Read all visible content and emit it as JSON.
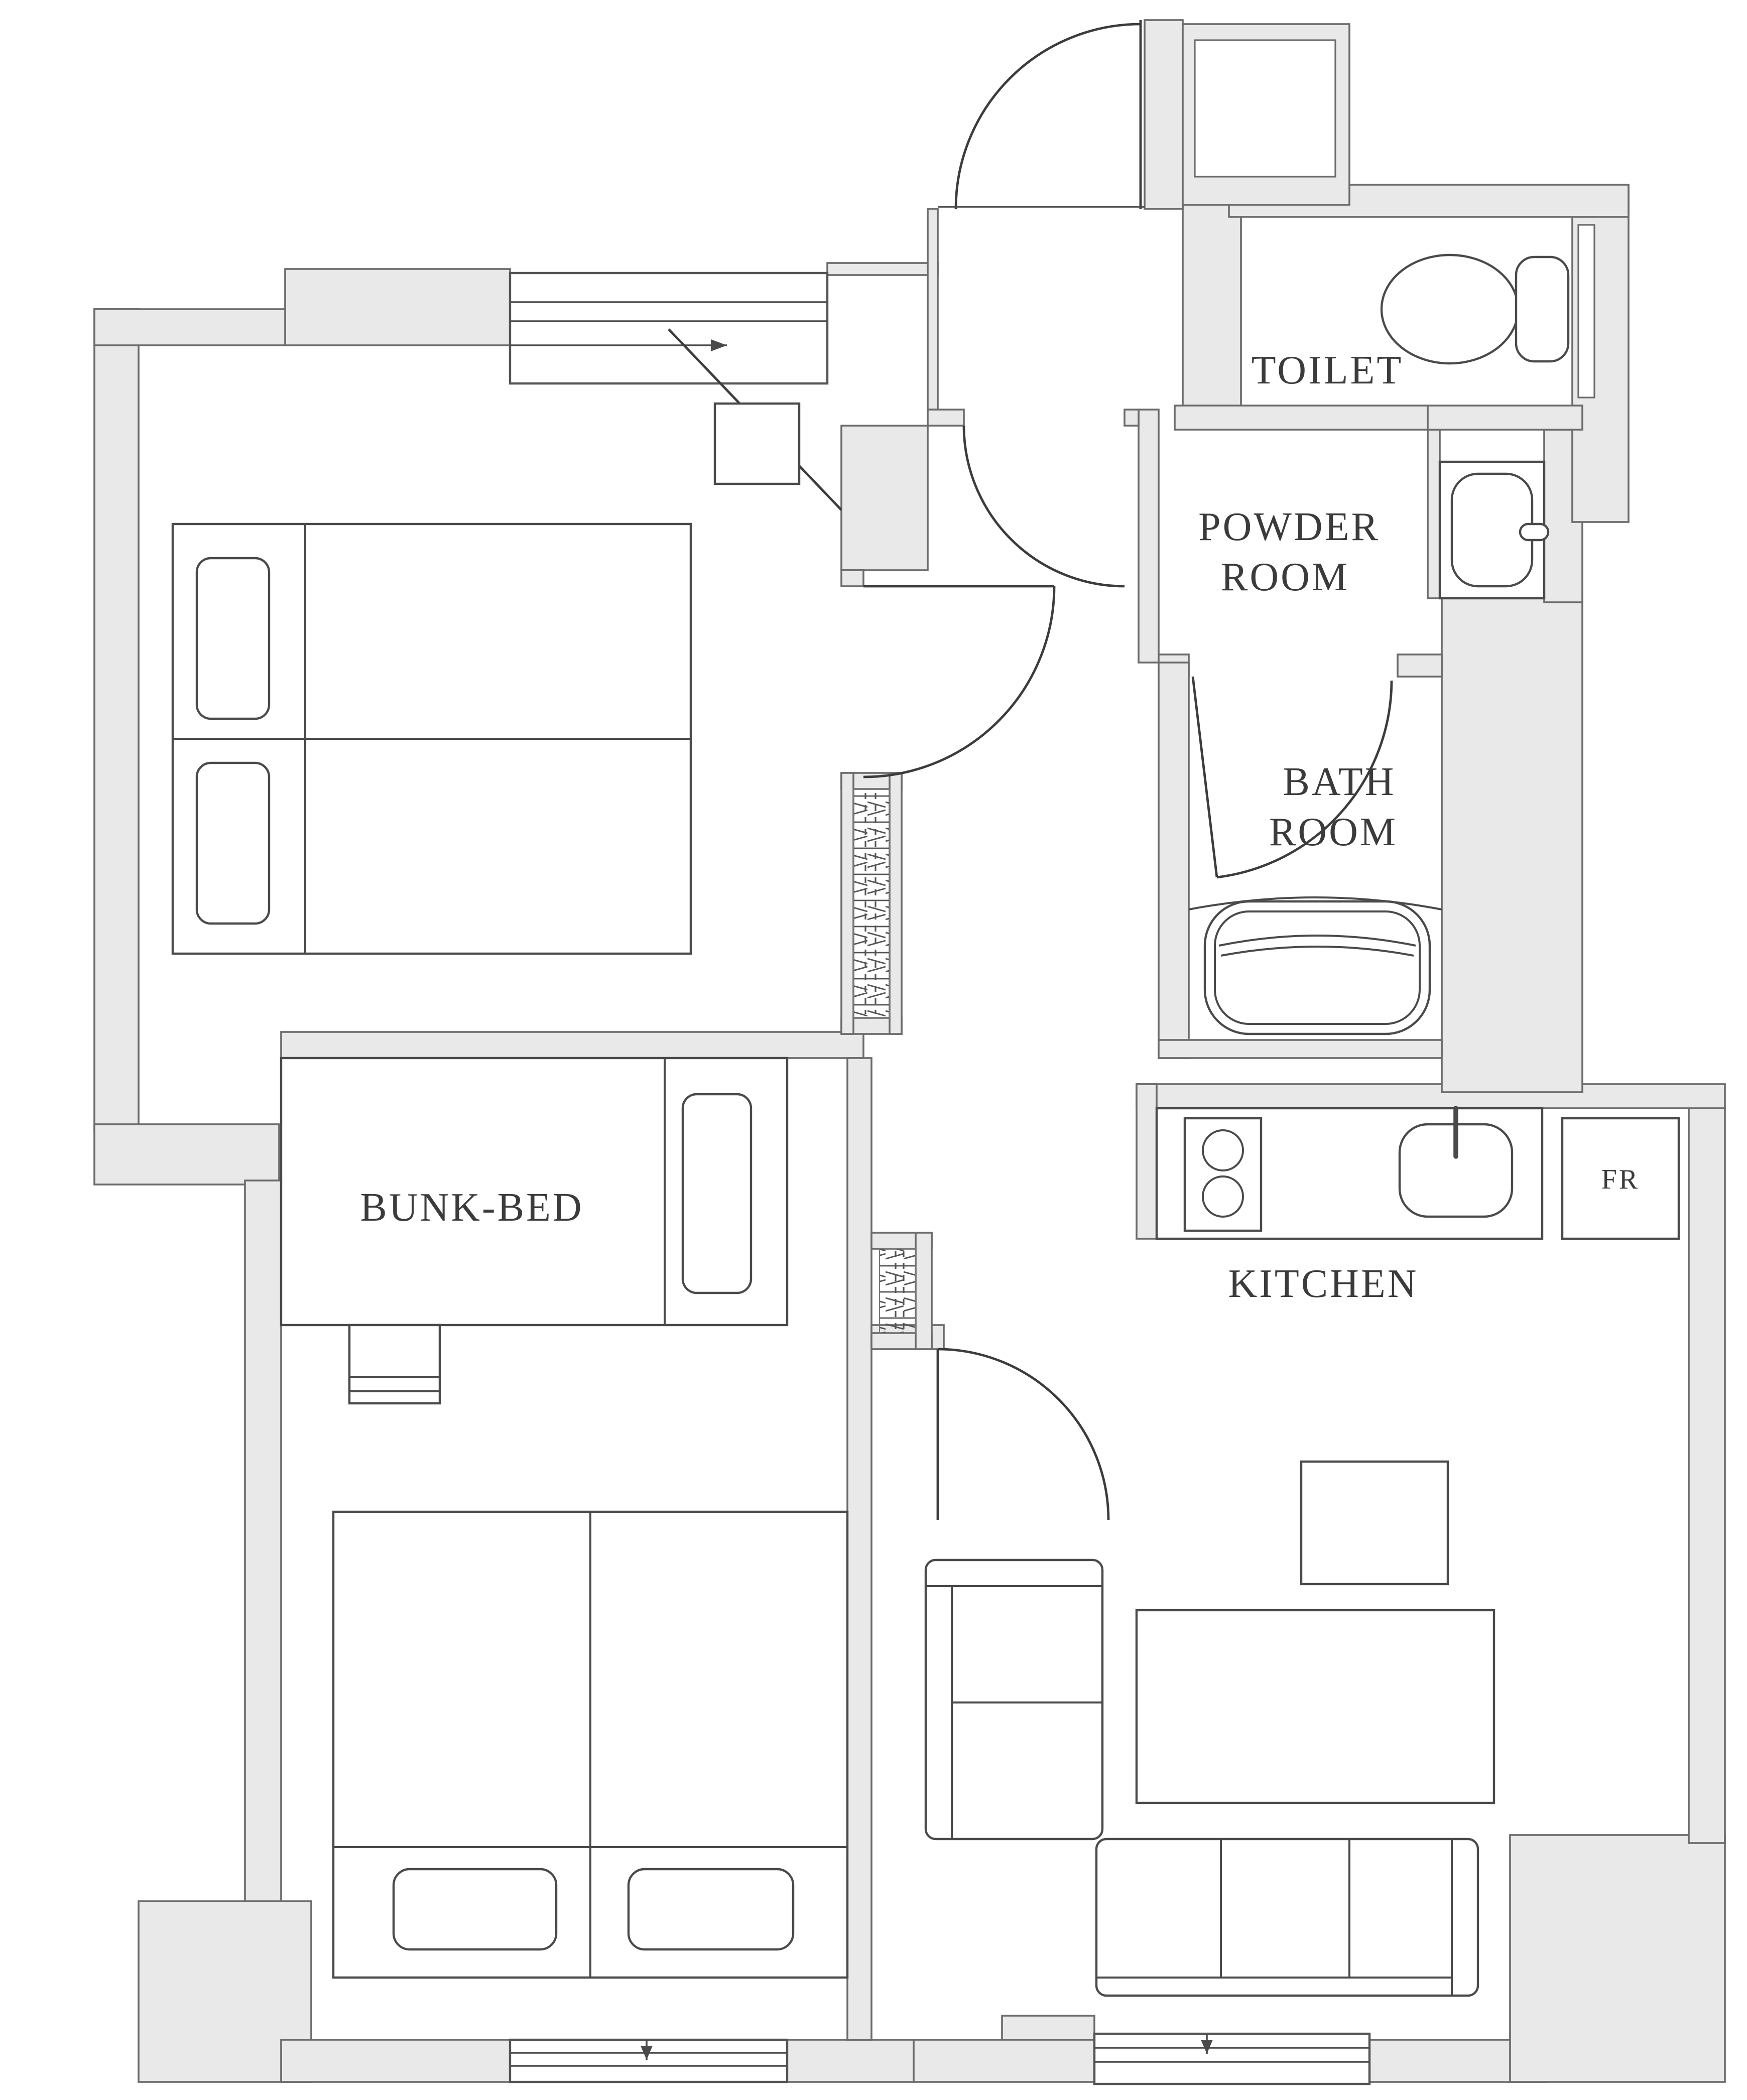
{
  "labels": {
    "toilet": "TOILET",
    "powder_line1": "POWDER",
    "powder_line2": "ROOM",
    "bath_line1": "BATH",
    "bath_line2": "ROOM",
    "bunk_bed": "BUNK-BED",
    "kitchen": "KITCHEN",
    "fridge": "FR"
  },
  "colors": {
    "wall_fill": "#e9e9e9",
    "wall_line": "#6b6b6b",
    "drawing_line": "#4a4a4a",
    "text": "#3b3b3b",
    "background": "#ffffff"
  }
}
